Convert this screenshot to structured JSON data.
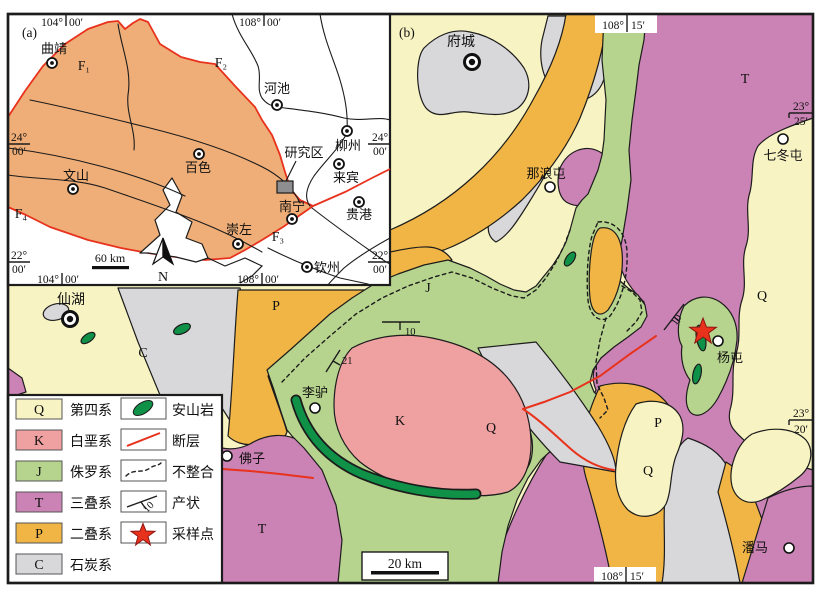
{
  "colors": {
    "quaternary": "#f7f3c2",
    "cretaceous": "#efa0a0",
    "jurassic": "#b7d48e",
    "triassic": "#cb82b5",
    "permian": "#f0b545",
    "carboniferous": "#d8d7da",
    "andesite": "#0f9147",
    "fault_red": "#e8321c",
    "inset_region_tan": "#efae78",
    "study_area_gray": "#8e8e90",
    "white": "#ffffff"
  },
  "panel_a": {
    "label": "(a)",
    "coords": {
      "lon_w_deg": "104°",
      "lon_w_min": "00′",
      "lon_e_deg": "108°",
      "lon_e_min": "00′",
      "lat_n_deg": "24°",
      "lat_n_min": "00′",
      "lat_s_deg": "22°",
      "lat_s_min": "00′"
    },
    "cities": [
      {
        "name": "曲靖"
      },
      {
        "name": "河池"
      },
      {
        "name": "柳州"
      },
      {
        "name": "百色"
      },
      {
        "name": "文山"
      },
      {
        "name": "来宾"
      },
      {
        "name": "南宁"
      },
      {
        "name": "贵港"
      },
      {
        "name": "崇左"
      },
      {
        "name": "钦州"
      }
    ],
    "study_area": "研究区",
    "faults": [
      {
        "label": "F₁"
      },
      {
        "label": "F₂"
      },
      {
        "label": "F₃"
      },
      {
        "label": "F₄"
      }
    ],
    "scale": "60 km",
    "north": "N"
  },
  "panel_b": {
    "label": "(b)",
    "coords": {
      "lon_deg": "108°",
      "lon_min": "15′",
      "lat_n_deg": "23°",
      "lat_n_min": "25′",
      "lat_s_deg": "23°",
      "lat_s_min": "20′"
    },
    "towns": [
      {
        "name": "府城"
      },
      {
        "name": "仙湖"
      },
      {
        "name": "那浪屯"
      },
      {
        "name": "七冬屯"
      },
      {
        "name": "杨屯"
      },
      {
        "name": "李驴"
      },
      {
        "name": "佛子"
      },
      {
        "name": "潘马"
      }
    ],
    "unit_labels": [
      {
        "code": "T"
      },
      {
        "code": "Q"
      },
      {
        "code": "J"
      },
      {
        "code": "Q"
      },
      {
        "code": "K"
      },
      {
        "code": "Q"
      },
      {
        "code": "P"
      },
      {
        "code": "P"
      },
      {
        "code": "C"
      },
      {
        "code": "T"
      }
    ],
    "dips": [
      {
        "value": "10"
      },
      {
        "value": "21"
      },
      {
        "value": "10"
      }
    ],
    "scale": "20 km"
  },
  "legend": {
    "units": [
      {
        "code": "Q",
        "name": "第四系"
      },
      {
        "code": "K",
        "name": "白垩系"
      },
      {
        "code": "J",
        "name": "侏罗系"
      },
      {
        "code": "T",
        "name": "三叠系"
      },
      {
        "code": "P",
        "name": "二叠系"
      },
      {
        "code": "C",
        "name": "石炭系"
      }
    ],
    "symbols": [
      {
        "name": "安山岩"
      },
      {
        "name": "断层"
      },
      {
        "name": "不整合"
      },
      {
        "name": "产状",
        "dip": "10"
      },
      {
        "name": "采样点"
      }
    ]
  }
}
